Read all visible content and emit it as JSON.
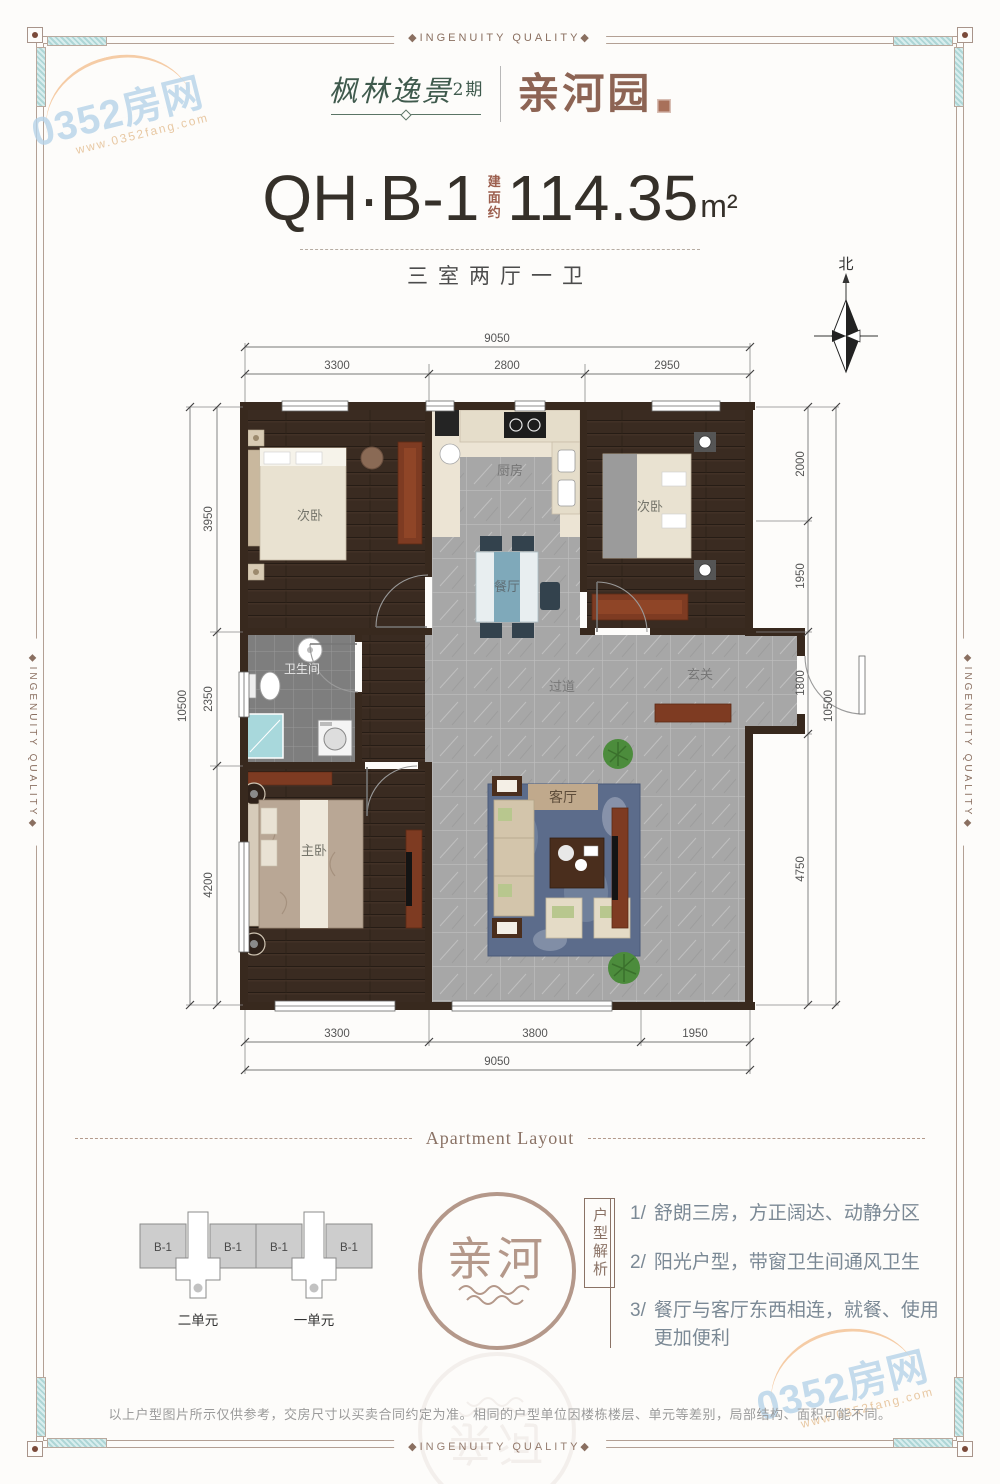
{
  "frame": {
    "quality_label": "◆INGENUITY QUALITY◆"
  },
  "watermark": {
    "brand": "0352房网",
    "site": "www.0352fang.com"
  },
  "header": {
    "project_name": "枫林逸景",
    "project_phase": "2期",
    "sub_brand": "亲河园"
  },
  "title": {
    "unit_code": "QH·B-1",
    "area_prefix": "建面约",
    "area_value": "114.35",
    "area_unit": "m²",
    "layout_summary": "三室两厅一卫"
  },
  "compass": {
    "north_label": "北"
  },
  "plan": {
    "rooms": [
      "次卧",
      "厨房",
      "次卧",
      "餐厅",
      "卫生间",
      "过道",
      "玄关",
      "主卧",
      "客厅"
    ],
    "dims": {
      "top": {
        "total": "9050",
        "segments": [
          "3300",
          "2800",
          "2950"
        ]
      },
      "bottom": {
        "total": "9050",
        "segments": [
          "3300",
          "3800",
          "1950"
        ]
      },
      "left": {
        "total": "10500",
        "segments": [
          "3950",
          "2350",
          "4200"
        ]
      },
      "right": {
        "total": "10500",
        "segments": [
          "2000",
          "1950",
          "1800",
          "4750"
        ]
      }
    }
  },
  "section": {
    "divider_label": "Apartment Layout"
  },
  "units_diagram": {
    "unit_label": "B-1",
    "units": [
      {
        "name": "二单元"
      },
      {
        "name": "一单元"
      }
    ]
  },
  "logo_circle": {
    "text": "亲河"
  },
  "analysis": {
    "heading": "户型解析",
    "points": [
      {
        "index": "1/",
        "text": "舒朗三房，方正阔达、动静分区"
      },
      {
        "index": "2/",
        "text": "阳光户型，带窗卫生间通风卫生"
      },
      {
        "index": "3/",
        "text": "餐厅与客厅东西相连，就餐、使用更加便利"
      }
    ]
  },
  "disclaimer": "以上户型图片所示仅供参考，交房尺寸以买卖合同约定为准。相同的户型单位因楼栋楼层、单元等差别，局部结构、面积可能不同。",
  "colors": {
    "brand_green": "#3f5a4d",
    "brand_brown": "#8d6454",
    "frame_line": "#b3a094",
    "corner_teal": "#bcdcdc",
    "wall": "#38291e",
    "tile_gray": "#a7a7a7",
    "wood_brown": "#3a2b21",
    "rug_blue": "#5c6c8b",
    "furniture_red": "#7e3b22",
    "watermark_blue": "#b7d4e9"
  }
}
